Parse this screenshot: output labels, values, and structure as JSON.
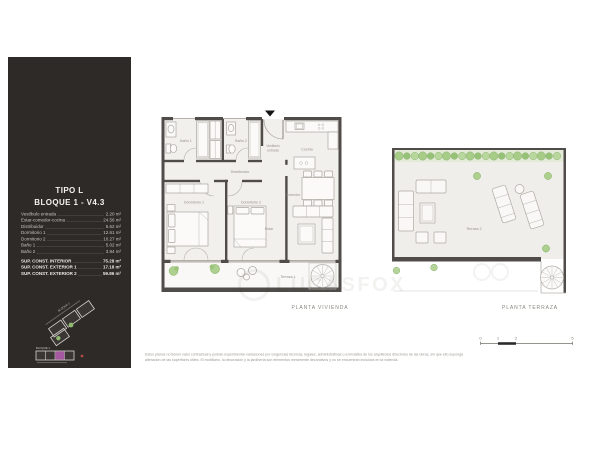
{
  "sidebar": {
    "title_line1": "TIPO L",
    "title_line2": "BLOQUE 1 - V4.3",
    "areas": [
      {
        "label": "Vestíbulo entrada",
        "value": "2.20 m²"
      },
      {
        "label": "Estar-comedor-cocina",
        "value": "24.56 m²"
      },
      {
        "label": "Distribuidor",
        "value": "5.62 m²"
      },
      {
        "label": "Dormitorio 1",
        "value": "12.61 m²"
      },
      {
        "label": "Dormitorio 2",
        "value": "10.27 m²"
      },
      {
        "label": "Baño 1",
        "value": "5.02 m²"
      },
      {
        "label": "Baño 2",
        "value": "3.84 m²"
      }
    ],
    "totals": [
      {
        "label": "SUP. CONST. INTERIOR",
        "value": "75.28 m²"
      },
      {
        "label": "SUP. CONST. EXTERIOR 1",
        "value": "17.18 m²"
      },
      {
        "label": "SUP. CONST. EXTERIOR 2",
        "value": "59.86 m²"
      }
    ],
    "minimap": {
      "block1_label": "BLOQUE 1",
      "block2_label": "BLOQUE 2",
      "highlight_color": "#a559a1"
    }
  },
  "plan_vivienda": {
    "caption": "PLANTA VIVIENDA",
    "labels": {
      "bano1": "Baño 1",
      "bano2": "Baño 2",
      "vestibulo_l1": "Vestíbulo",
      "vestibulo_l2": "entrada",
      "distribuidor": "Distribuidor",
      "cocina": "Cocina",
      "comedor": "Comedor",
      "estar": "Estar",
      "dormitorio1": "Dormitorio 1",
      "dormitorio2": "Dormitorio 2",
      "terraza1": "Terraza 1"
    }
  },
  "plan_terraza": {
    "caption": "PLANTA TERRAZA",
    "labels": {
      "terraza2": "Terraza 2"
    }
  },
  "scale_bar": {
    "ticks": [
      "0",
      "1",
      "2",
      "5"
    ]
  },
  "watermark": {
    "text": "LUCASFOX"
  },
  "disclaimer": {
    "line1": "Estos planos no tienen valor contractual y podrán experimentar variaciones por exigencias técnicas, legales, administrativas o a iniciativa de los arquitectos directores de las obras, sin que ello suponga",
    "line2": "alteración de las superficies útiles. El mobiliario, la decoración y la jardinería son elementos meramente decorativos y no se encuentran incluidos en la vivienda."
  },
  "colors": {
    "sidebar_bg": "#2d2a27",
    "wall": "#4f4c49",
    "floor": "#f2f0ed",
    "plant_green": "#a6cc88",
    "highlight_purple": "#a559a1"
  }
}
